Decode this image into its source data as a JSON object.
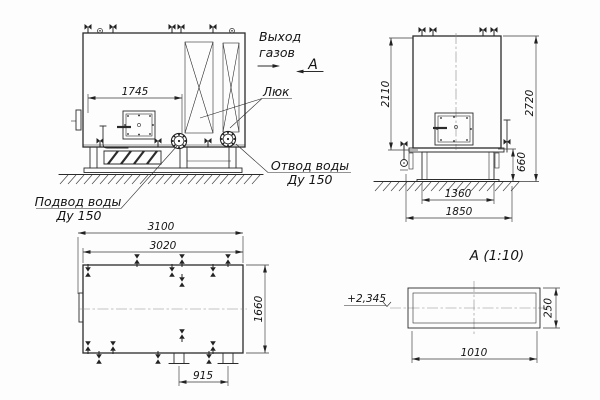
{
  "labels": {
    "gas_outlet_line1": "Выход",
    "gas_outlet_line2": "газов",
    "section_letter": "А",
    "hatch": "Люк",
    "water_outlet_line1": "Отвод воды",
    "water_outlet_line2": "Ду 150",
    "water_supply_line1": "Подвод воды",
    "water_supply_line2": "Ду 150",
    "section_title": "А  (1:10)",
    "elevation_mark": "+2,345"
  },
  "dimensions": {
    "front_hatch_span": "1745",
    "side_upper_height": "2110",
    "side_total_height": "2720",
    "side_base_height": "660",
    "side_base_width": "1360",
    "side_overall_width": "1850",
    "plan_overall_length": "3100",
    "plan_body_length": "3020",
    "plan_width": "1660",
    "plan_duct_spacing": "915",
    "section_duct_width": "1010",
    "section_duct_height": "250"
  }
}
